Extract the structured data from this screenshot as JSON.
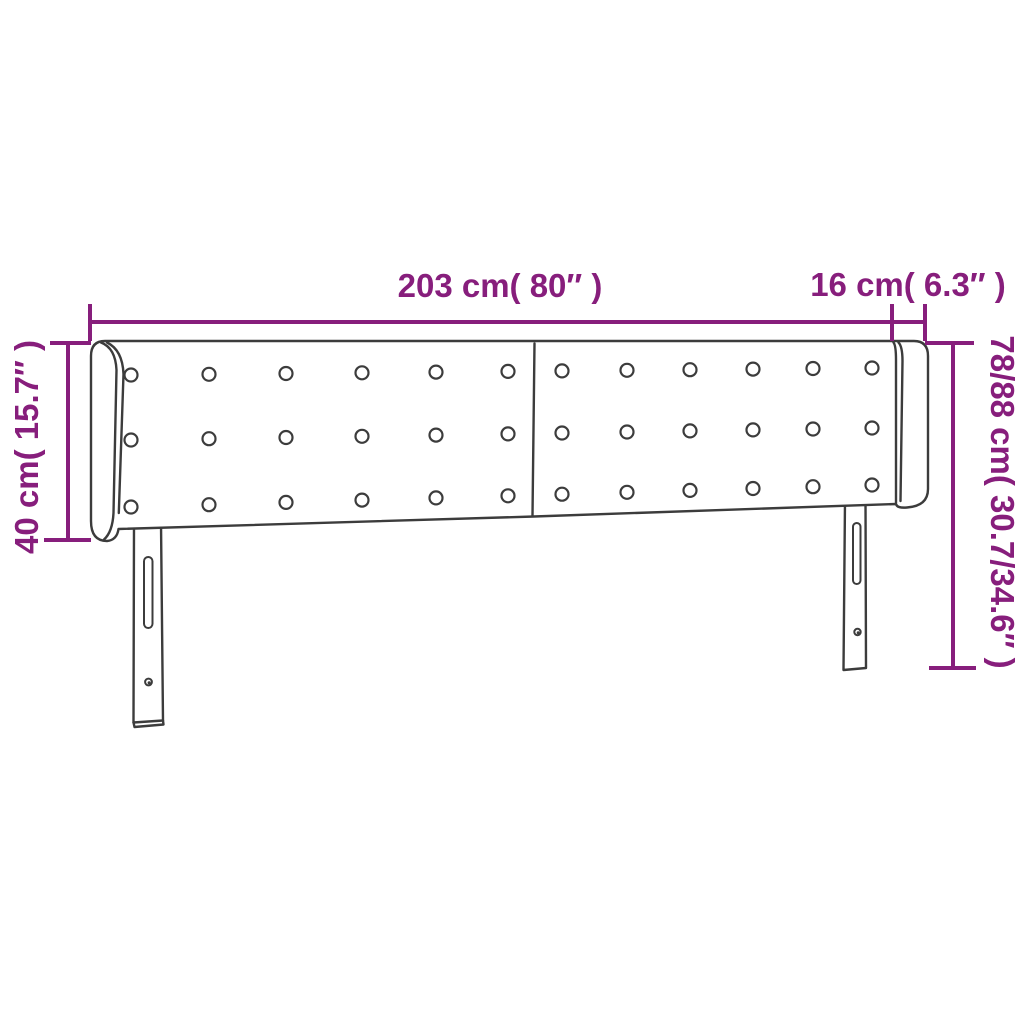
{
  "colors": {
    "accent": "#871E7C",
    "line": "#3C3C3C",
    "background": "#ffffff"
  },
  "labels": {
    "total_width": "203 cm( 80″ )",
    "wing_width": "16 cm( 6.3″ )",
    "headboard_height": "40 cm( 15.7″ )",
    "total_height": "78/88 cm( 30.7/34.6″ )"
  }
}
